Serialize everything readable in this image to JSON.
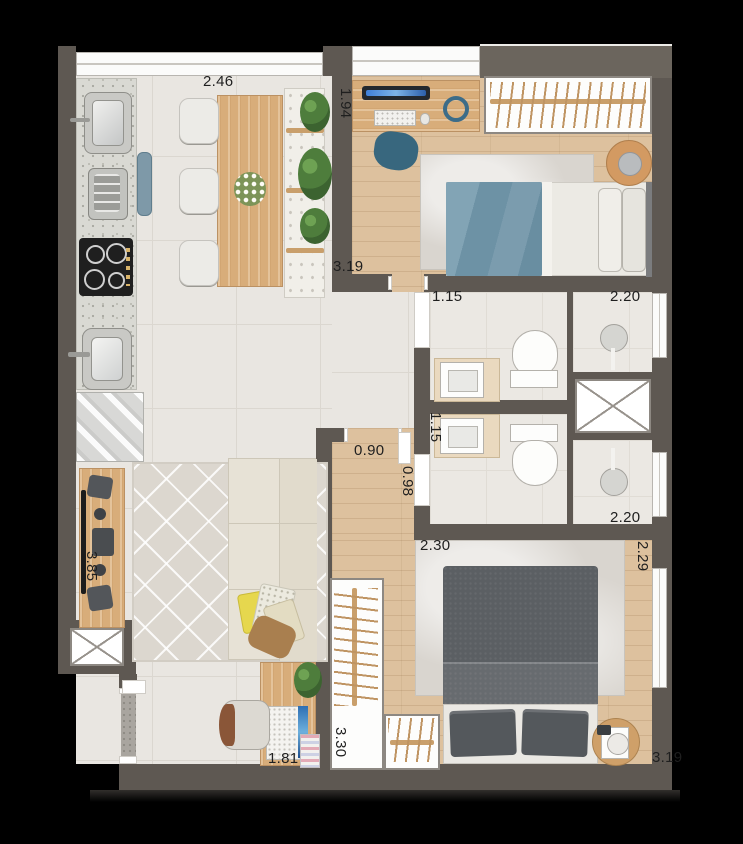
{
  "labels": {
    "dining_width": "2.46",
    "bedroom1_depth": "1.94",
    "bedroom1_width": "3.19",
    "bath1_vanity_width": "1.15",
    "bath1_shower_width": "2.20",
    "bath2_vanity_width": "1.15",
    "hall_opening_width": "0.90",
    "hall_width": "0.98",
    "bath2_shower_width": "2.20",
    "master_width": "2.30",
    "master_depth": "2.29",
    "living_depth": "3.85",
    "master_closet_depth": "3.30",
    "desk_width": "1.81",
    "master_bed_width": "3.19"
  },
  "colors": {
    "background": "#000000",
    "wall": "#5e5852",
    "tile_floor": "#e9e6e1",
    "wood_floor": "#ddc19e",
    "bathroom_floor": "#ebe8e3",
    "kitchen_counter": "#d9d9d3",
    "furniture_wood": "#d8ad7a",
    "master_bed": "#5b5f63",
    "bedroom1_duvet": "#7195a8",
    "sofa": "#e7e2d6",
    "accent_pillow": "#e6d74e",
    "plant": "#4e7d3c",
    "label_text": "#1f1f1f"
  }
}
